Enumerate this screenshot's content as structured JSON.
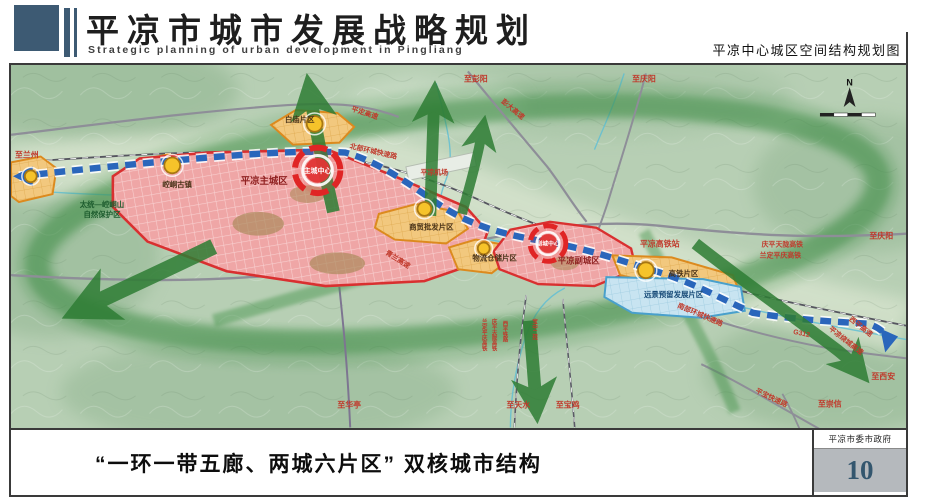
{
  "header": {
    "title": "平凉市城市发展战略规划",
    "subtitle_en": "Strategic planning of urban development in Pingliang",
    "right_title": "平凉中心城区空间结构规划图"
  },
  "footer": {
    "caption": "“一环一带五廊、两城六片区” 双核城市结构",
    "agency": "平凉市委市政府",
    "page_number": "10"
  },
  "map": {
    "compass": "N",
    "labels": {
      "zhi_lanzhou": "至兰州",
      "pingding_expwy": "平定高速",
      "zhi_pengyang": "至彭阳",
      "pengda_expwy": "彭大高速",
      "zhi_qingyang_top": "至庆阳",
      "north_ring_road": "北部环城快速路",
      "baimiao_district": "白庙片区",
      "pingliang_airport": "平凉机场",
      "main_city": "平凉主城区",
      "main_city_center": "主城中心",
      "kongtong_town": "崆峒古镇",
      "nature_reserve_1": "太统—崆峒山",
      "nature_reserve_2": "自然保护区",
      "qinglan_expwy": "青兰高速",
      "wholesale_district": "商贸批发片区",
      "logistics_district": "物流仓储片区",
      "sub_city_center": "副城中心",
      "sub_city": "平凉副城区",
      "hsr_station": "平凉高铁站",
      "hsr_district": "高铁片区",
      "reserved_district": "远景预留发展片区",
      "south_ring_road": "南部环城快速路",
      "qingping_hsr": "庆平天陇高铁",
      "landing_hsr": "兰定平庆高铁",
      "zhi_qingyang_right": "至庆阳",
      "g312": "G312",
      "xiping_expwy": "西平高速",
      "raocheng_expwy": "平凉绕城高速",
      "pingbao_expwy": "平宝快速路",
      "zhi_xian": "至西安",
      "zhi_chongxin": "至崇信",
      "zhi_huating": "至华亭",
      "zhi_tianshui": "至天水",
      "zhi_baoji": "至宝鸡",
      "rail_v1": "兰定平庆高铁",
      "rail_v2": "庆平天陇高铁",
      "rail_v3": "西平铁路",
      "rail_v4": "宝中二线"
    }
  },
  "colors": {
    "header_accent": "#3d5a73",
    "main_city_red": "#e03030",
    "district_orange": "#e8921e",
    "reserved_blue": "#49a0cc",
    "corridor_green": "#2e7d34",
    "axis_blue": "#2a66bb",
    "label_red": "#c0392b",
    "pagenum_bg": "#b5b9bd"
  }
}
